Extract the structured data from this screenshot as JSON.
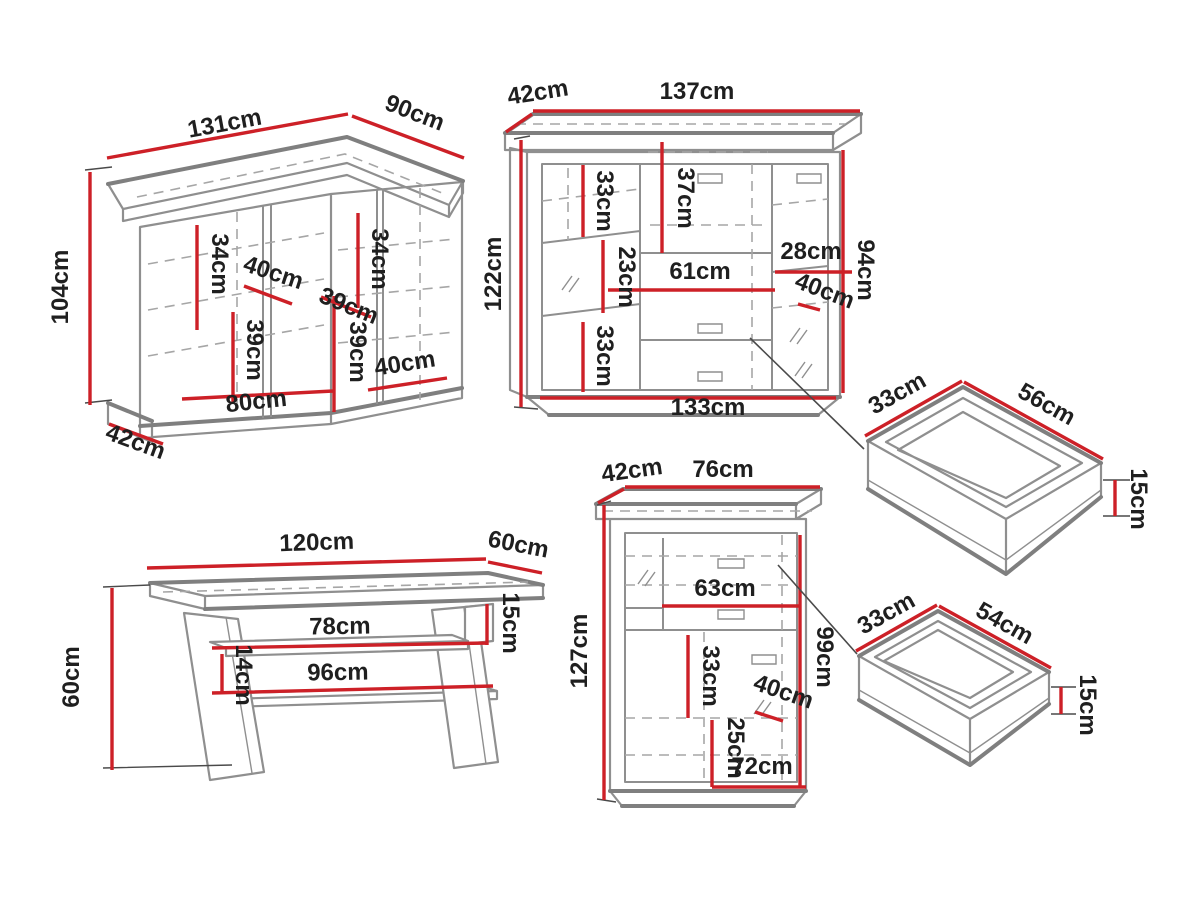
{
  "colors": {
    "background": "#ffffff",
    "dimension_red": "#cd2027",
    "outline_gray": "#8f8f8f",
    "edge_gray": "#7f7f7f",
    "dash_gray": "#a6a6a6",
    "label_ink": "#1f1f1f",
    "leader_dark": "#4a4a4a"
  },
  "pieces": {
    "corner_cabinet": {
      "labels": {
        "top_width": "131cm",
        "top_depth_right": "90cm",
        "height": "104cm",
        "base_depth": "42cm",
        "inner_left_height": "34cm",
        "inner_shelf_depth": "40cm",
        "inner_right_height": "34cm",
        "inner_diagonal": "39cm",
        "inner_corner_height": "39cm",
        "inner_lower_left_height": "39cm",
        "bottom_width": "80cm",
        "bottom_right_width": "40cm"
      }
    },
    "highboard": {
      "labels": {
        "top_depth": "42cm",
        "top_width": "137cm",
        "height": "122cm",
        "upper_left_shelf_height": "33cm",
        "upper_middle_height": "37cm",
        "middle_left_height": "23cm",
        "middle_width": "61cm",
        "right_shelf_width": "28cm",
        "right_inner_height": "94cm",
        "right_depth": "40cm",
        "lower_left_shelf_height": "33cm",
        "bottom_width": "133cm"
      }
    },
    "drawer_large": {
      "labels": {
        "depth": "33cm",
        "width": "56cm",
        "height": "15cm"
      }
    },
    "coffee_table": {
      "labels": {
        "top_width": "120cm",
        "top_depth": "60cm",
        "height": "60cm",
        "top_shelf_gap": "15cm",
        "upper_shelf_width": "78cm",
        "shelf_gap": "14cm",
        "lower_shelf_width": "96cm"
      }
    },
    "cabinet": {
      "labels": {
        "top_depth": "42cm",
        "top_width": "76cm",
        "height": "127cm",
        "middle_width": "63cm",
        "right_inner_height": "99cm",
        "inner_left_height": "33cm",
        "inner_depth": "40cm",
        "lower_inner_height": "25cm",
        "bottom_width": "72cm"
      }
    },
    "drawer_small": {
      "labels": {
        "depth": "33cm",
        "width": "54cm",
        "height": "15cm"
      }
    }
  }
}
